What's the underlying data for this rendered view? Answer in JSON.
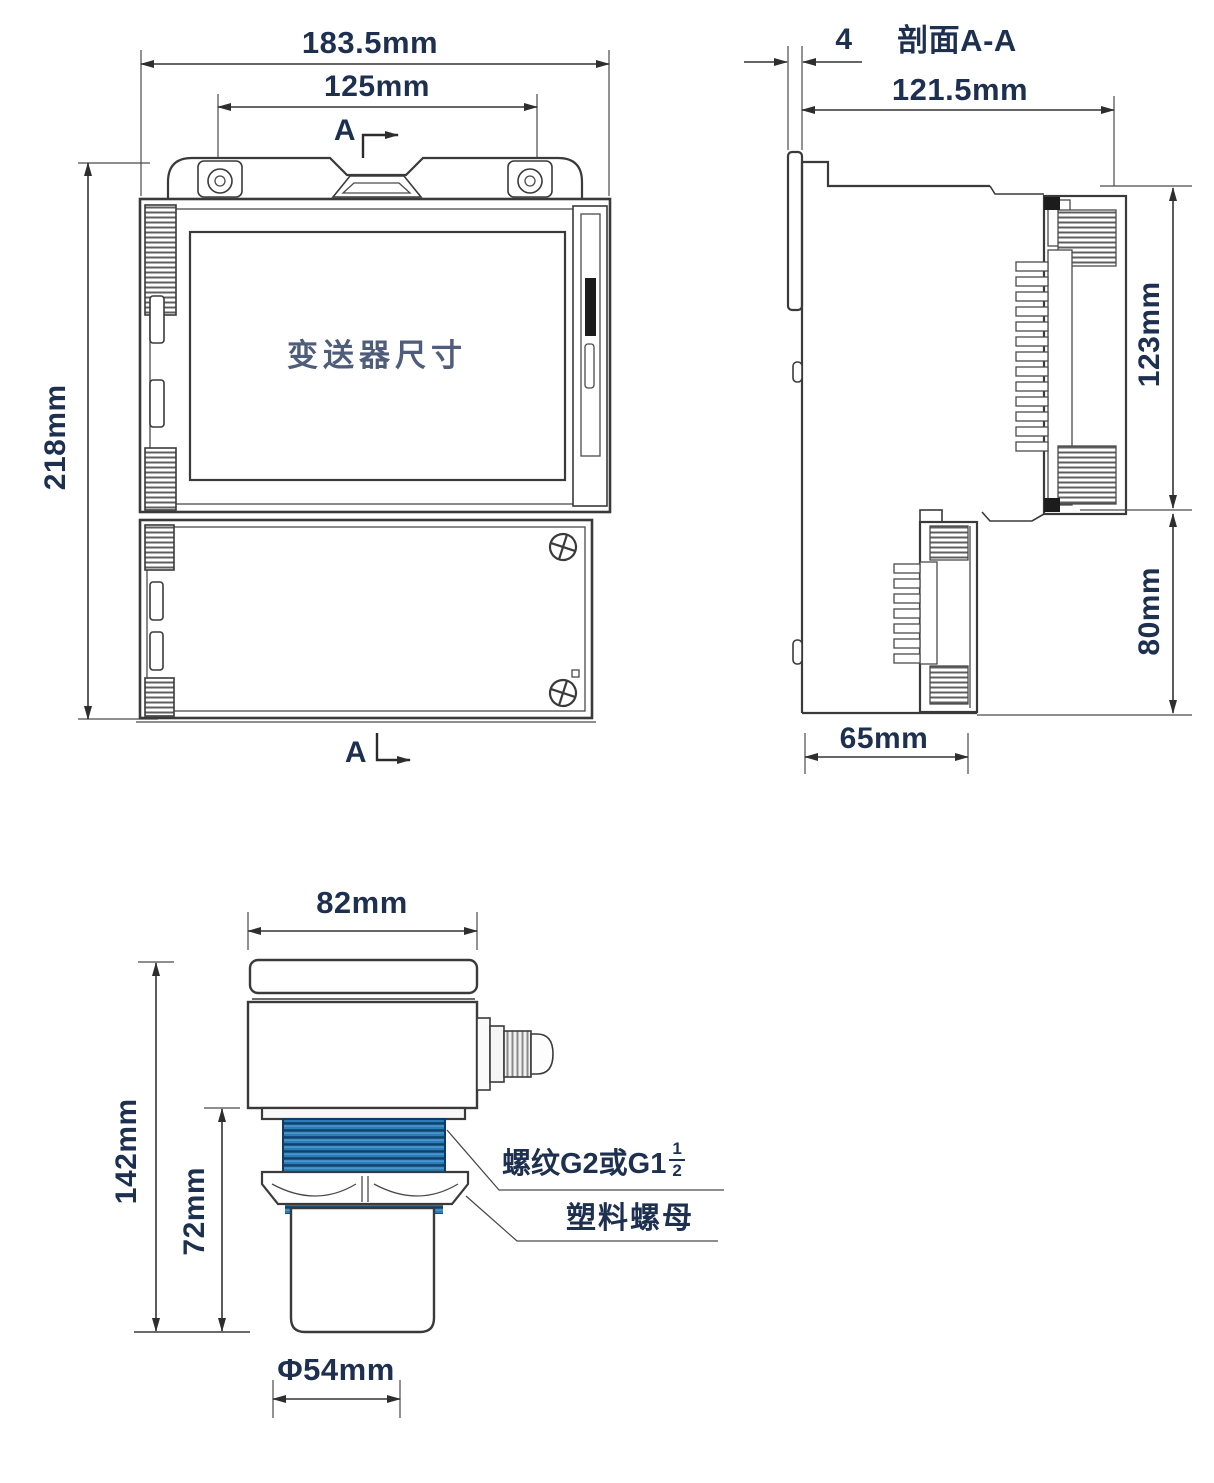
{
  "front_view": {
    "width_dim": "183.5mm",
    "inner_width_dim": "125mm",
    "height_dim": "218mm",
    "screen_label": "变送器尺寸",
    "section_marker_top": "A",
    "section_marker_bottom": "A"
  },
  "side_view": {
    "title": "剖面A-A",
    "plate_thickness_dim": "4",
    "width_dim": "121.5mm",
    "upper_height_dim": "123mm",
    "lower_height_dim": "80mm",
    "depth_dim": "65mm"
  },
  "sensor_view": {
    "width_dim": "82mm",
    "total_height_dim": "142mm",
    "lower_height_dim": "72mm",
    "probe_diameter_dim": "Φ54mm",
    "thread_label": "螺纹G2或G1",
    "thread_fraction_numerator": "1",
    "thread_fraction_denominator": "2",
    "nut_label": "塑料螺母"
  },
  "colors": {
    "line": "#3a3a3a",
    "dim_text": "#1e3050",
    "thread_blue": "#2c7cb8"
  }
}
